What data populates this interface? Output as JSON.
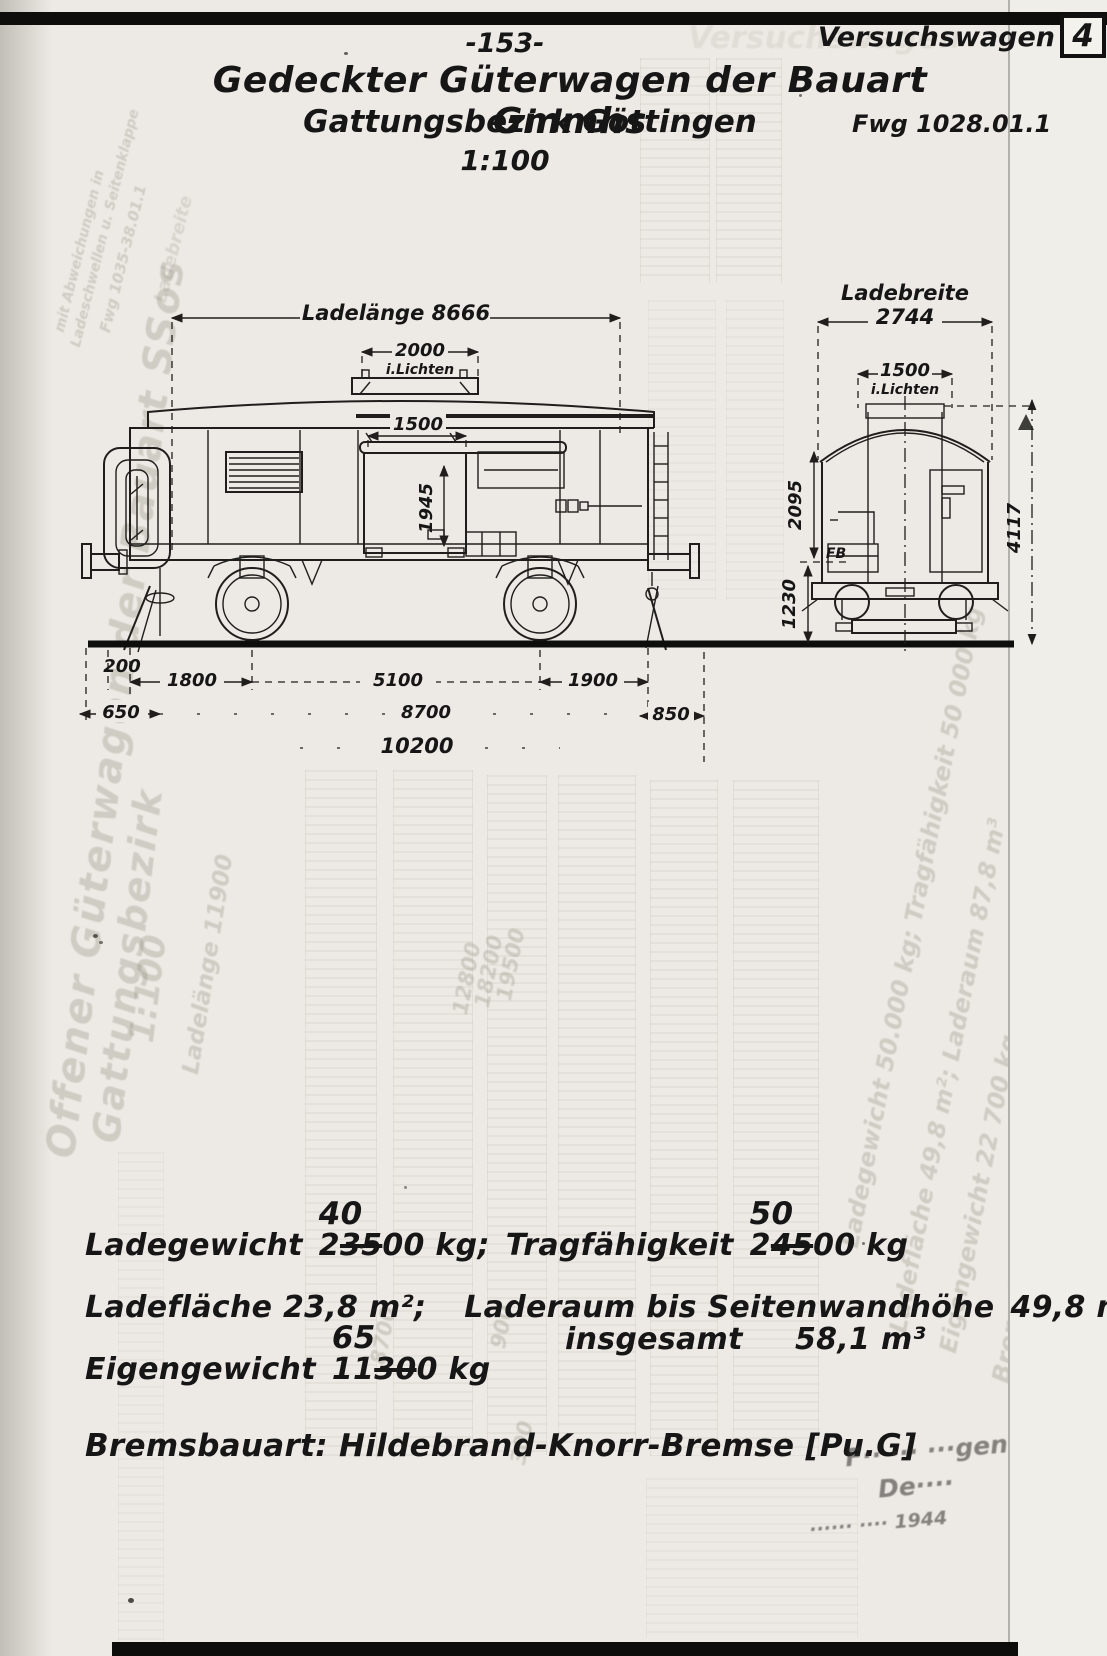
{
  "page": {
    "number": "-153-",
    "corner_label": "Versuchswagen",
    "corner_number": "4",
    "title": "Gedeckter Güterwagen der Bauart Gmmhs",
    "subtitle": "Gattungsbezirk Göttingen",
    "scale": "1:100",
    "drawing_ref": "Fwg 1028.01.1"
  },
  "side_view": {
    "length_label": "Ladelänge 8666",
    "roof_opening_value": "2000",
    "roof_opening_note": "i.Lichten",
    "door_width": "1500",
    "door_height": "1945"
  },
  "end_view": {
    "width_label": "Ladebreite",
    "width_value": "2744",
    "opening_value": "1500",
    "opening_note": "i.Lichten",
    "body_height": "2095",
    "buffer_height": "1230",
    "total_height": "4117",
    "floor_mark": "FB"
  },
  "underframe_dims": {
    "overhang": "200",
    "end_to_axle": "1800",
    "wheelbase": "5100",
    "axle_to_end": "1900",
    "buffer_left": "650",
    "frame_length": "8700",
    "buffer_right": "850",
    "total_length": "10200"
  },
  "specs": {
    "ladegewicht_label": "Ladegewicht",
    "ladegewicht_pre": "2",
    "ladegewicht_struck": "35",
    "ladegewicht_corr": "40",
    "ladegewicht_post": "00 kg;",
    "tragfaehigkeit_label": "Tragfähigkeit",
    "tragfaehigkeit_pre": "2",
    "tragfaehigkeit_struck": "45",
    "tragfaehigkeit_corr": "50",
    "tragfaehigkeit_post": "00 kg",
    "ladeflaeche": "Ladefläche 23,8 m²;",
    "laderaum_label": "Laderaum bis Seitenwandhöhe",
    "laderaum_value": "49,8 m³",
    "insgesamt_label": "insgesamt",
    "insgesamt_value": "58,1 m³",
    "eigengewicht_label": "Eigengewicht",
    "eigengewicht_pre": "11",
    "eigengewicht_struck": "30",
    "eigengewicht_corr": "65",
    "eigengewicht_post": "0 kg",
    "bremsbauart": "Bremsbauart: Hildebrand-Knorr-Bremse [Pu.G]"
  },
  "stamp": {
    "line1": "F·· ··· ···gen",
    "line2": "De····",
    "line3": "······ ···· 1944"
  },
  "ghost": {
    "echo_header": "Versuchswagen",
    "left_title": "Offener Güterwagen der Bauart SSos",
    "left_subtitle": "Gattungsbezirk",
    "left_scale": "1:100",
    "corner_note1": "mit Abweichungen in",
    "corner_note2": "Ladeschwellen u. Seitenklappe",
    "corner_note3": "Fwg 1035-38.01.1",
    "corner_note4": "Ladebreite",
    "right_line1": "Ladegewicht 50.000 kg; Tragfähigkeit 50 000 kg",
    "right_line2": "Ladefläche 49,8 m²; Laderaum 87,8 m³",
    "right_line3": "Eigengewicht 22 700 kg",
    "right_line4": "Bremsbauart: Hildebrand-Knorr-Bremse [Pu G]",
    "mid_num1": "12800",
    "mid_num2": "18200",
    "mid_num3": "19500",
    "mid_label1": "Ladelänge 11900",
    "mid_num4": "8700",
    "mid_num5": "900",
    "mid_num6": "300"
  },
  "colors": {
    "ink": "#1f1e1c",
    "paper": "#edeae5",
    "ghost": "#8d8878"
  }
}
